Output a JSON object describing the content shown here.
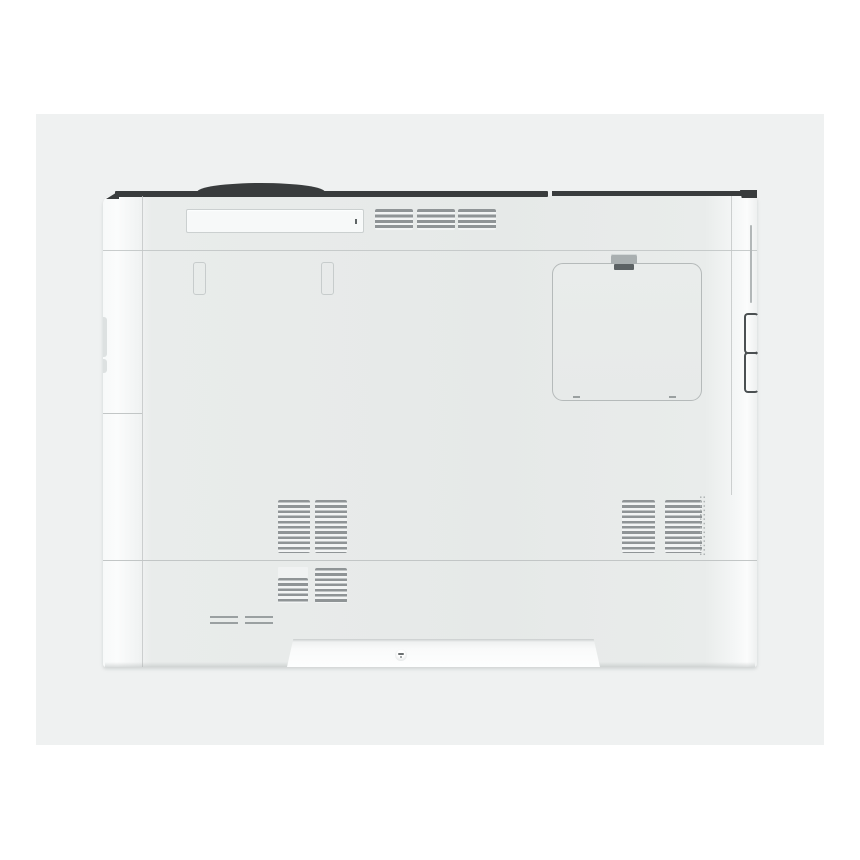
{
  "scene": {
    "type": "product-photo",
    "subject": "office laser printer, rear-side view on light gray backdrop",
    "visible_text": "none"
  },
  "colors": {
    "bg": "#ffffff",
    "panel": "#eff1f1",
    "body": "#e7eae9",
    "strip-dark": "#393c3d",
    "seam": "#c2c6c6",
    "vent": "#8f9496",
    "vent-light": "#f2f4f4",
    "slot-fill": "#f7f9f9",
    "clip": "#a9afb0",
    "clip-dark": "#5c6264",
    "label": "#9aa0a1",
    "handle-dark": "#4b5052"
  },
  "parts": [
    "backdrop-panel",
    "printer-top-hump",
    "printer-top-edge-strip",
    "top-handle-slot",
    "top-exhaust-vents",
    "rear-cover-hinge-cutouts",
    "access-panel-door",
    "access-panel-latch",
    "side-groove",
    "side-handle-recess",
    "mid-exhaust-vents-left",
    "mid-exhaust-vents-right",
    "perforation-dots",
    "paper-tray-seam",
    "lower-vents",
    "rating-label-lines",
    "bottom-recess",
    "recess-screw"
  ]
}
